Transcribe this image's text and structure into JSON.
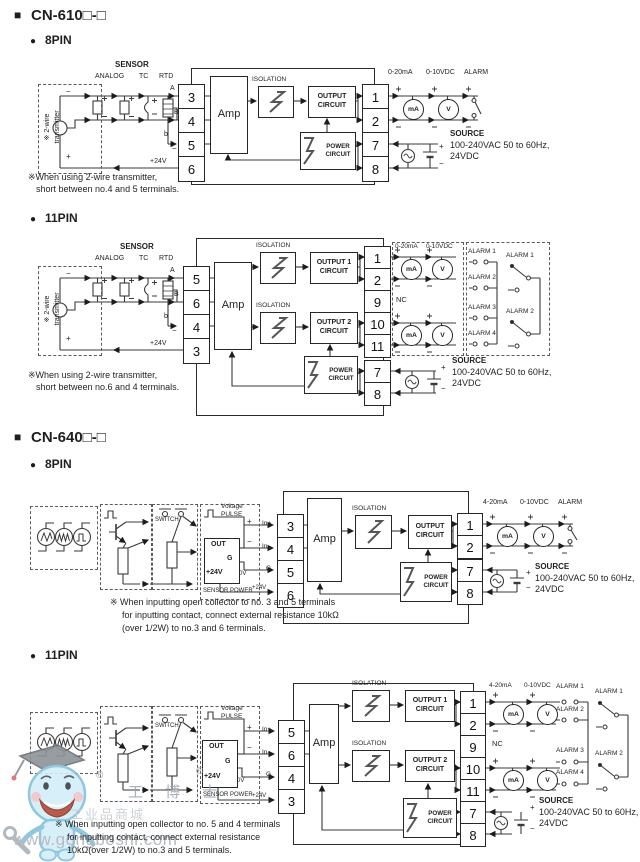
{
  "sym": {
    "plus": "+",
    "minus": "−",
    "square": "■",
    "bullet": "●"
  },
  "cn610": {
    "title": "CN-610□-□"
  },
  "cn640": {
    "title": "CN-640□-□"
  },
  "cn610_8pin": {
    "pin_heading": "8PIN",
    "sensor": "SENSOR",
    "analog": "ANALOG",
    "tc": "TC",
    "rtd": "RTD",
    "rtd_a": "A",
    "rtd_b_upper": "B",
    "rtd_b_lower": "b",
    "transmitter_line1": "※ 2-wire",
    "transmitter_line2": "transmitter",
    "v24": "+24V",
    "terminals_in": [
      "3",
      "4",
      "5",
      "6"
    ],
    "terminals_out": [
      "1",
      "2",
      "7",
      "8"
    ],
    "amp": "Amp",
    "isolation": "ISOLATION",
    "output_circuit": "OUTPUT CIRCUIT",
    "power_circuit": "POWER CIRCUIT",
    "out_current": "0-20mA",
    "out_voltage": "0-10VDC",
    "out_alarm": "ALARM",
    "meter_ma": "mA",
    "meter_v": "V",
    "source": {
      "title": "SOURCE",
      "line1": "100-240VAC 50 to 60Hz,",
      "line2": "24VDC"
    },
    "note_line1": "※When using 2-wire transmitter,",
    "note_line2": "short between no.4 and 5 terminals."
  },
  "cn610_11pin": {
    "pin_heading": "11PIN",
    "sensor": "SENSOR",
    "analog": "ANALOG",
    "tc": "TC",
    "rtd": "RTD",
    "rtd_a": "A",
    "rtd_b_upper": "B",
    "rtd_b_lower": "b",
    "transmitter_line1": "※ 2-wire",
    "transmitter_line2": "transmitter",
    "v24": "+24V",
    "terminals_in": [
      "5",
      "6",
      "4",
      "3"
    ],
    "terminals_out": [
      "1",
      "2",
      "9",
      "10",
      "11",
      "7",
      "8"
    ],
    "nc": "NC",
    "amp": "Amp",
    "isolation": "ISOLATION",
    "output1_circuit": "OUTPUT 1 CIRCUIT",
    "output2_circuit": "OUTPUT 2 CIRCUIT",
    "power_circuit": "POWER CIRCUIT",
    "out_current": "0-20mA",
    "out_voltage": "0-10VDC",
    "meter_ma": "mA",
    "meter_v": "V",
    "alarm_contacts": [
      "ALARM 1",
      "ALARM 2",
      "ALARM 3",
      "ALARM 4"
    ],
    "alarm_relays": [
      "ALARM 1",
      "ALARM 2"
    ],
    "source": {
      "title": "SOURCE",
      "line1": "100-240VAC 50 to 60Hz,",
      "line2": "24VDC"
    },
    "note_line1": "※When using 2-wire transmitter,",
    "note_line2": "short between no.6 and 4 terminals."
  },
  "cn640_8pin": {
    "pin_heading": "8PIN",
    "switch": "SWITCH",
    "voltage": "Voltage",
    "pulse": "PULSE",
    "out_box": {
      "out": "OUT",
      "g": "G",
      "v24": "+24V"
    },
    "sensor_power": "SENSOR POWER",
    "zero_v": "0V",
    "in_plus": "In+",
    "in_minus": "In-",
    "g": "G",
    "v24": "+24V",
    "terminals_in": [
      "3",
      "4",
      "5",
      "6"
    ],
    "terminals_out": [
      "1",
      "2",
      "7",
      "8"
    ],
    "amp": "Amp",
    "isolation": "ISOLATION",
    "output_circuit": "OUTPUT CIRCUIT",
    "power_circuit": "POWER CIRCUIT",
    "out_current": "4-20mA",
    "out_voltage": "0-10VDC",
    "out_alarm": "ALARM",
    "meter_ma": "mA",
    "meter_v": "V",
    "source": {
      "title": "SOURCE",
      "line1": "100-240VAC 50 to 60Hz,",
      "line2": "24VDC"
    },
    "note_line1": "※ When inputting open collector to no. 3 and 5 terminals",
    "note_line2": "for inputting contact, connect external resistance 10kΩ",
    "note_line3": "(over 1/2W) to no.3 and 6 terminals."
  },
  "cn640_11pin": {
    "pin_heading": "11PIN",
    "switch": "SWITCH",
    "voltage": "Voltage",
    "pulse": "PULSE",
    "out_box": {
      "out": "OUT",
      "g": "G",
      "v24": "+24V"
    },
    "sensor_power": "SENSOR POWER",
    "zero_v": "0V",
    "in_plus": "In+",
    "in_minus": "In-",
    "g": "G",
    "v24": "+24V",
    "terminals_in": [
      "5",
      "6",
      "4",
      "3"
    ],
    "terminals_out": [
      "1",
      "2",
      "9",
      "10",
      "11",
      "7",
      "8"
    ],
    "nc": "NC",
    "amp": "Amp",
    "isolation": "ISOLATION",
    "output1_circuit": "OUTPUT 1 CIRCUIT",
    "output2_circuit": "OUTPUT 2 CIRCUIT",
    "power_circuit": "POWER CIRCUIT",
    "out_current": "4-20mA",
    "out_voltage": "0-10VDC",
    "meter_ma": "mA",
    "meter_v": "V",
    "alarm_contacts": [
      "ALARM 1",
      "ALARM 2",
      "ALARM 3",
      "ALARM 4"
    ],
    "alarm_relays": [
      "ALARM 1",
      "ALARM 2"
    ],
    "source": {
      "title": "SOURCE",
      "line1": "100-240VAC 50 to 60Hz,",
      "line2": "24VDC"
    },
    "note_line1": "※ When inputting open collector to no. 5 and 4 terminals",
    "note_line2": "for inputting contact, connect external resistance",
    "note_line3": "10kΩ(over 1/2W) to no.3 and 5 terminals."
  },
  "watermark": {
    "registered": "®",
    "brand": "工 博 士",
    "shop_text": "工业品商城",
    "url": "www.gongboshi.com"
  }
}
